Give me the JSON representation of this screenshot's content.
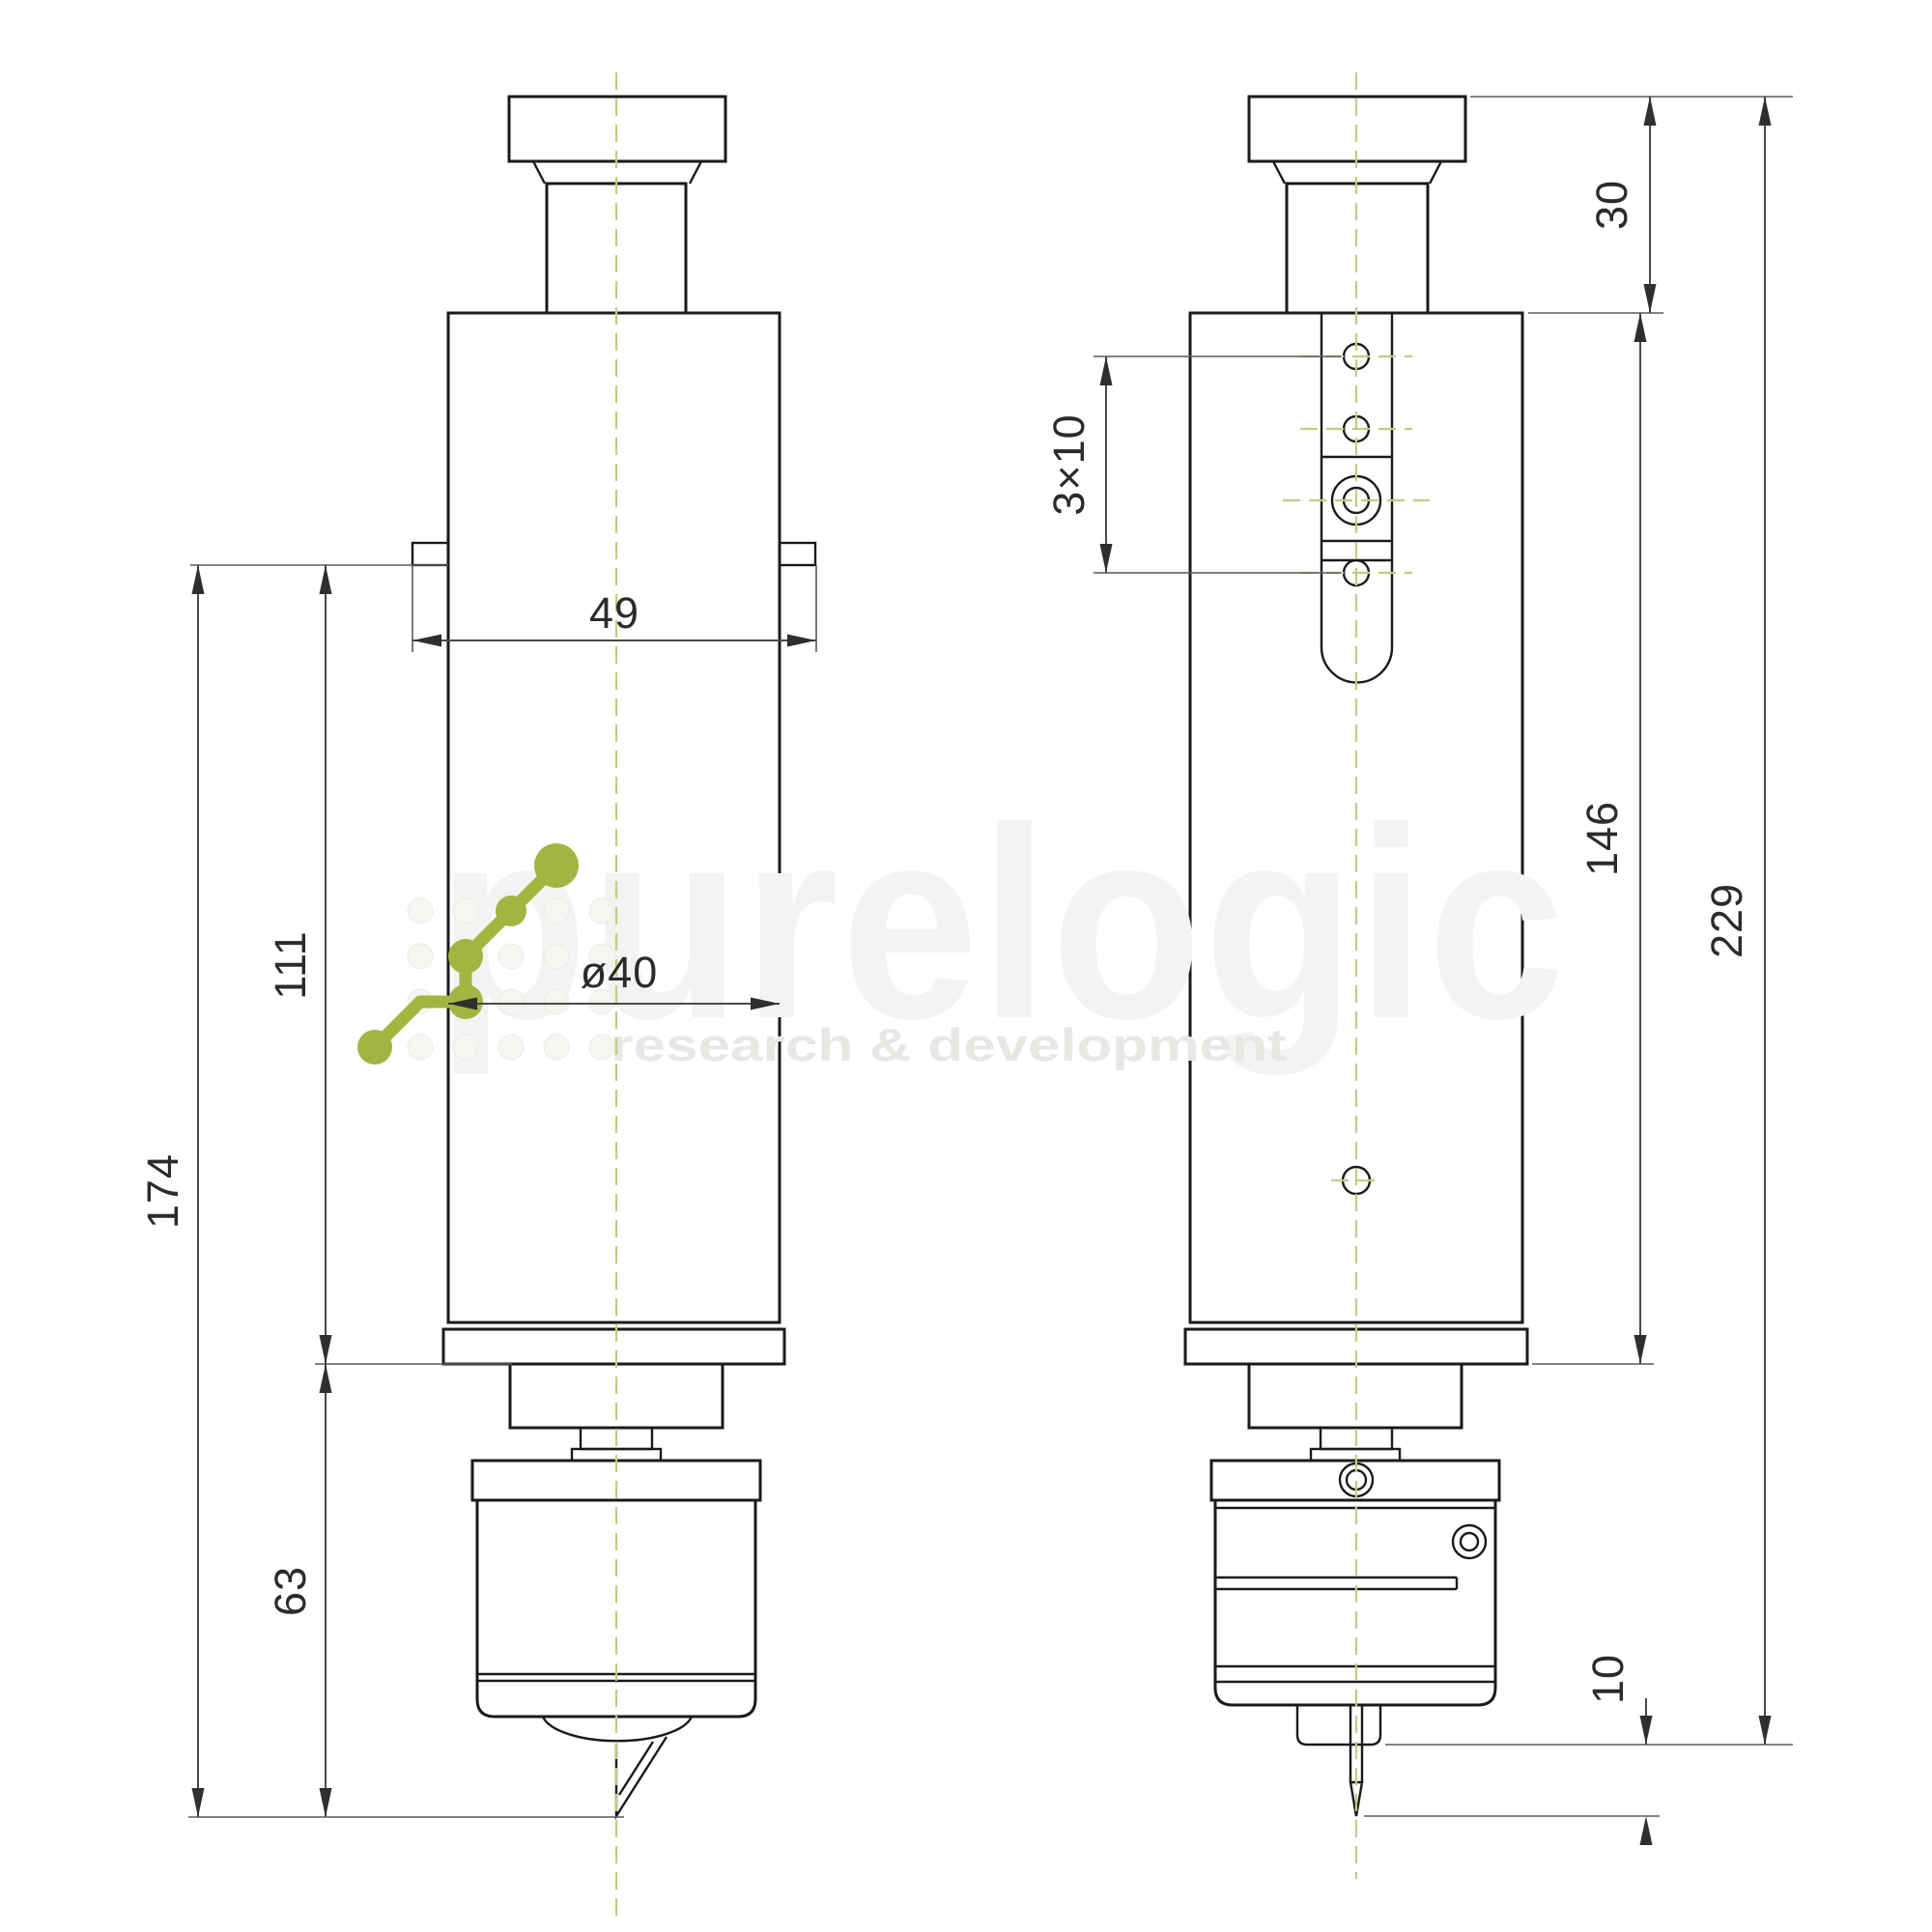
{
  "document": {
    "type": "technical-dimension-drawing",
    "views": [
      "front",
      "side"
    ]
  },
  "dimensions": {
    "d49": "49",
    "d40": "ø40",
    "d174": "174",
    "d111": "111",
    "d63": "63",
    "d3x10": "3×10",
    "d30": "30",
    "d146": "146",
    "d229": "229",
    "d10": "10"
  },
  "watermark": {
    "brand": "purelogic",
    "tagline": "research & development"
  },
  "colors": {
    "outline": "#1a1a1a",
    "dimension_lines": "#4a4a4a",
    "centerline": "#c5ca83",
    "logo_green": "#a4b441",
    "watermark_brand": "#f3f3f1",
    "watermark_tagline": "#e7e7e4"
  }
}
